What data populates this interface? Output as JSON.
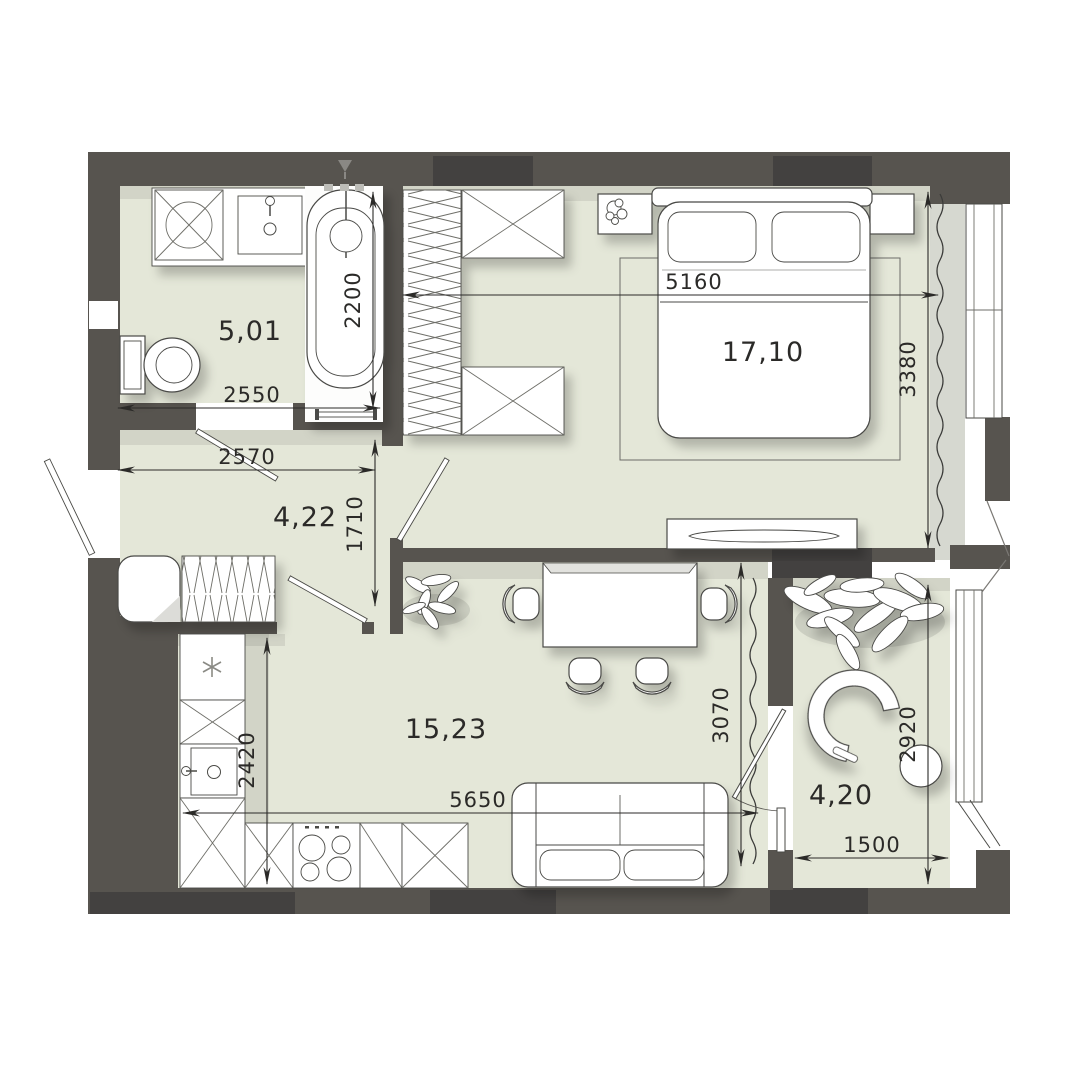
{
  "plan_title": "apartment-floor-plan",
  "colors": {
    "wall": "#57544f",
    "wall_dark": "#434140",
    "floor": "#e4e7d8",
    "window_recess": "#d6d8d0",
    "dimension_line": "#2b2a28",
    "furniture_stroke": "#4a4a46"
  },
  "rooms": {
    "bathroom": {
      "area": "5,01"
    },
    "hallway": {
      "area": "4,22"
    },
    "bedroom": {
      "area": "17,10"
    },
    "living_kitchen": {
      "area": "15,23"
    },
    "balcony": {
      "area": "4,20"
    }
  },
  "dimensions": {
    "bathroom_width": "2550",
    "bathtub_length": "2200",
    "hallway_width": "2570",
    "hallway_depth": "1710",
    "bedroom_width": "5160",
    "bedroom_depth": "3380",
    "kitchen_depth": "2420",
    "living_width": "5650",
    "living_depth": "3070",
    "balcony_depth": "2920",
    "balcony_width": "1500"
  }
}
